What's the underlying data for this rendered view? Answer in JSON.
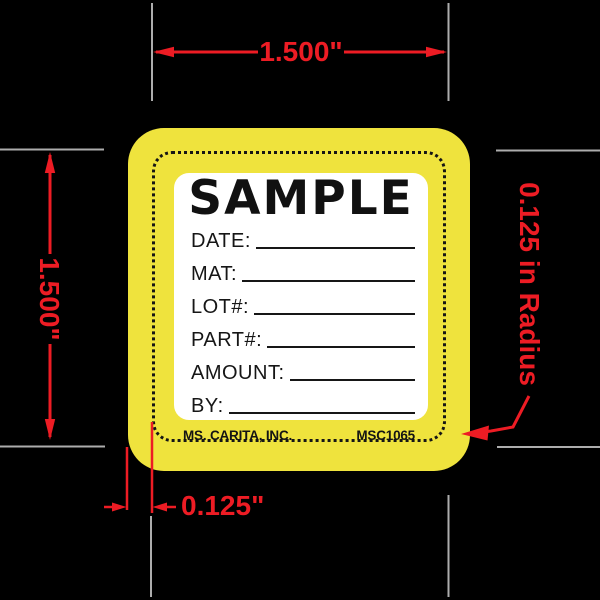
{
  "dimensions": {
    "width_label": "1.500\"",
    "height_label": "1.500\"",
    "margin_label": "0.125\"",
    "radius_label": "0.125 in Radius"
  },
  "label": {
    "sample_text": "SAMPLE",
    "fields": [
      {
        "label": "DATE:"
      },
      {
        "label": "MAT:"
      },
      {
        "label": "LOT#:"
      },
      {
        "label": "PART#:"
      },
      {
        "label": "AMOUNT:"
      },
      {
        "label": "BY:"
      }
    ],
    "company": "MS. CARITA, INC.",
    "part_number": "MSC1065"
  },
  "colors": {
    "background": "#000000",
    "label_yellow": "#EFE33D",
    "label_white": "#FFFFFF",
    "dimension_red": "#ED1C24",
    "extension_gray": "#ADADAD",
    "text_black": "#151515"
  }
}
